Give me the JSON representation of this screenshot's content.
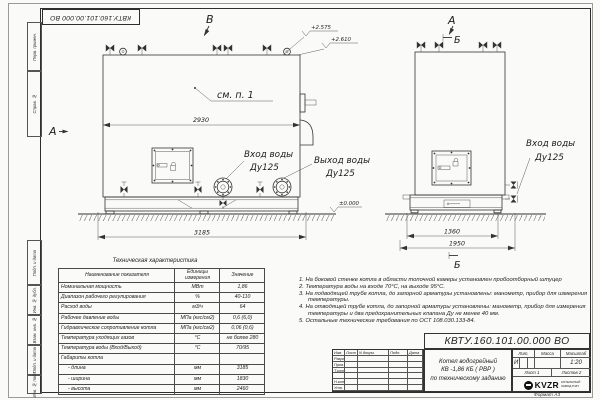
{
  "doc_number": "КВТУ.160.101.00.000  ВО",
  "format_label": "Формат  А3",
  "frame": {
    "side_labels": [
      "Перв. примен.",
      "Справ. №",
      "Подп. и дата",
      "Инв. № дубл.",
      "Взам. инв. №",
      "Подп. и дата",
      "Инв. № подл."
    ]
  },
  "drawing": {
    "front": {
      "marker_b": "В",
      "marker_a": "А",
      "note_ref": "см. п. 1",
      "dim_body": "2930",
      "dim_total": "3185",
      "elev1": "+2.575",
      "elev2": "+2.610",
      "elev_zero": "±0.000",
      "inlet_line1": "Вход воды",
      "inlet_line2": "Ду125",
      "outlet_line1": "Выход воды",
      "outlet_line2": "Ду125"
    },
    "side": {
      "marker_a": "А",
      "marker_b_top": "Б",
      "marker_b_bottom": "Б",
      "inlet_line1": "Вход воды",
      "inlet_line2": "Ду125",
      "dim_inner": "1360",
      "dim_total": "1950"
    }
  },
  "spec_table": {
    "title": "Техническая характеристика",
    "headers": [
      "Наименование показателя",
      "Единицы измерения",
      "Значение"
    ],
    "rows": [
      [
        "Номинальная мощность",
        "МВт",
        "1,86"
      ],
      [
        "Диапазон рабочего регулирования",
        "%",
        "40-110"
      ],
      [
        "Расход воды",
        "м3/ч",
        "64"
      ],
      [
        "Рабочее давление воды",
        "МПа (кгс/см2)",
        "0,6 (6,0)"
      ],
      [
        "Гидравлическое сопротивление котла",
        "МПа (кгс/см2)",
        "0,06 (0,6)"
      ],
      [
        "Температура уходящих газов",
        "°С",
        "не более 280"
      ],
      [
        "Температура воды (Вход/Выход)",
        "°С",
        "70/95"
      ],
      [
        "Габариты котла",
        "",
        ""
      ],
      [
        "- длина",
        "мм",
        "3185"
      ],
      [
        "- ширина",
        "мм",
        "1830"
      ],
      [
        "- высота",
        "мм",
        "2460"
      ]
    ]
  },
  "notes": [
    "1.  На боковой стенке котла в области топочной камеры установлен пробоотборный штуцер",
    "2.  Температура воды на входе 70°С, на выходе 95°С.",
    "3.  На подводящей трубе котла, до запорной арматуры установлены: манометр, прибор для измерения температуры.",
    "4.  На отводящей трубе котла, до запорной арматуры установлены: манометр, прибор для измерения температуры и два предохранительных клапана Ду не менее 40 мм.",
    "5.  Остальные технические требования по ОСТ 108.030.133-84."
  ],
  "title_block": {
    "rev_headers": [
      "Изм.",
      "Лист",
      "N докум.",
      "Подп.",
      "Дата"
    ],
    "roles": [
      "Разраб.",
      "Пров.",
      "Т.контр.",
      "",
      "Н.контр.",
      "Утв."
    ],
    "product_line1": "Котел водогрейный",
    "product_line2": "КВ -1,86  КБ  ( РВР )",
    "product_line3": "по техническому заданию",
    "lit_header": "Лит.",
    "mass_header": "Масса",
    "scale_header": "Масштаб",
    "lit_value": "И",
    "scale_value": "1:20",
    "sheet": "Лист  1",
    "sheets": "Листов  2",
    "logo_text": "KVZR",
    "logo_sub1": "КОТЕЛЬНЫЙ",
    "logo_sub2": "ЗАВОД РЭП"
  }
}
